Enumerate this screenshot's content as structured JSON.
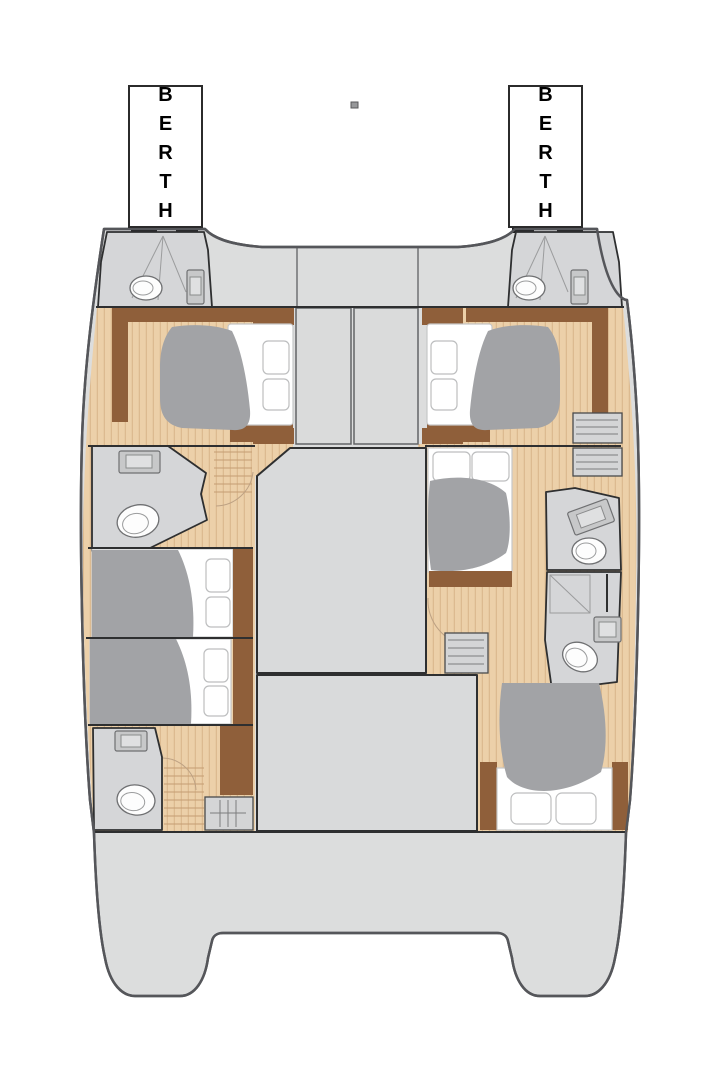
{
  "labels": {
    "berth_left": "BERTH",
    "berth_right": "BERTH"
  },
  "colors": {
    "bg": "#ffffff",
    "hull": "#dcdddd",
    "room": "#d5d6d8",
    "saloon": "#d9dadb",
    "wood": "#ecd0a9",
    "wood-stripe": "#dcba90",
    "brown": "#8f5f3a",
    "blanket": "#a2a3a6",
    "mattress": "#ffffff",
    "fixture": "#c7c8c9",
    "wall": "#2e2f30",
    "outline": "#55565a",
    "label-ink": "#000000",
    "label-border": "#2b2b2b"
  }
}
